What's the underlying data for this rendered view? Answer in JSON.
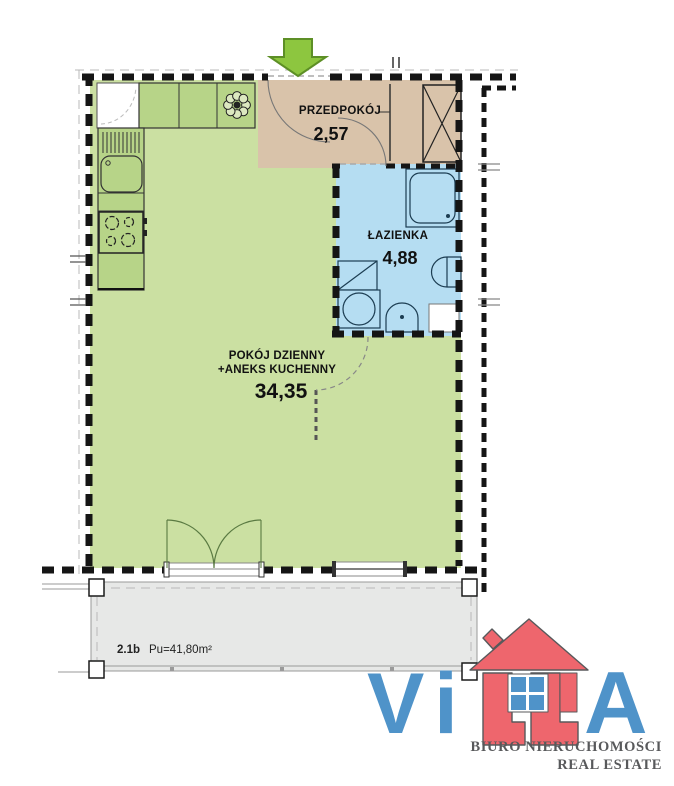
{
  "plan": {
    "rooms": {
      "hallway": {
        "label": "PRZEDPOKÓJ",
        "area": "2,57"
      },
      "bathroom": {
        "label": "ŁAZIENKA",
        "area": "4,88"
      },
      "living": {
        "label_line1": "POKÓJ DZIENNY",
        "label_line2": "+ANEKS KUCHENNY",
        "area": "34,35"
      }
    },
    "balcony": {
      "unit": "2.1b",
      "area": "Pu=41,80m²"
    }
  },
  "logo": {
    "letter_v": "V",
    "letter_i": "i",
    "letter_a": "A",
    "tagline_line1": "BIURO NIERUCHOMOŚCI",
    "tagline_line2": "REAL ESTATE"
  },
  "colors": {
    "living_room": "#cbe0a2",
    "kitchen_counter": "#b7d488",
    "hallway": "#d9c3aa",
    "bathroom": "#b5ddf2",
    "balcony": "#e7e8e7",
    "entrance_arrow": "#8dc63f",
    "logo_blue": "#4f93c9",
    "logo_red": "#ee666d",
    "logo_text": "#58595b"
  }
}
